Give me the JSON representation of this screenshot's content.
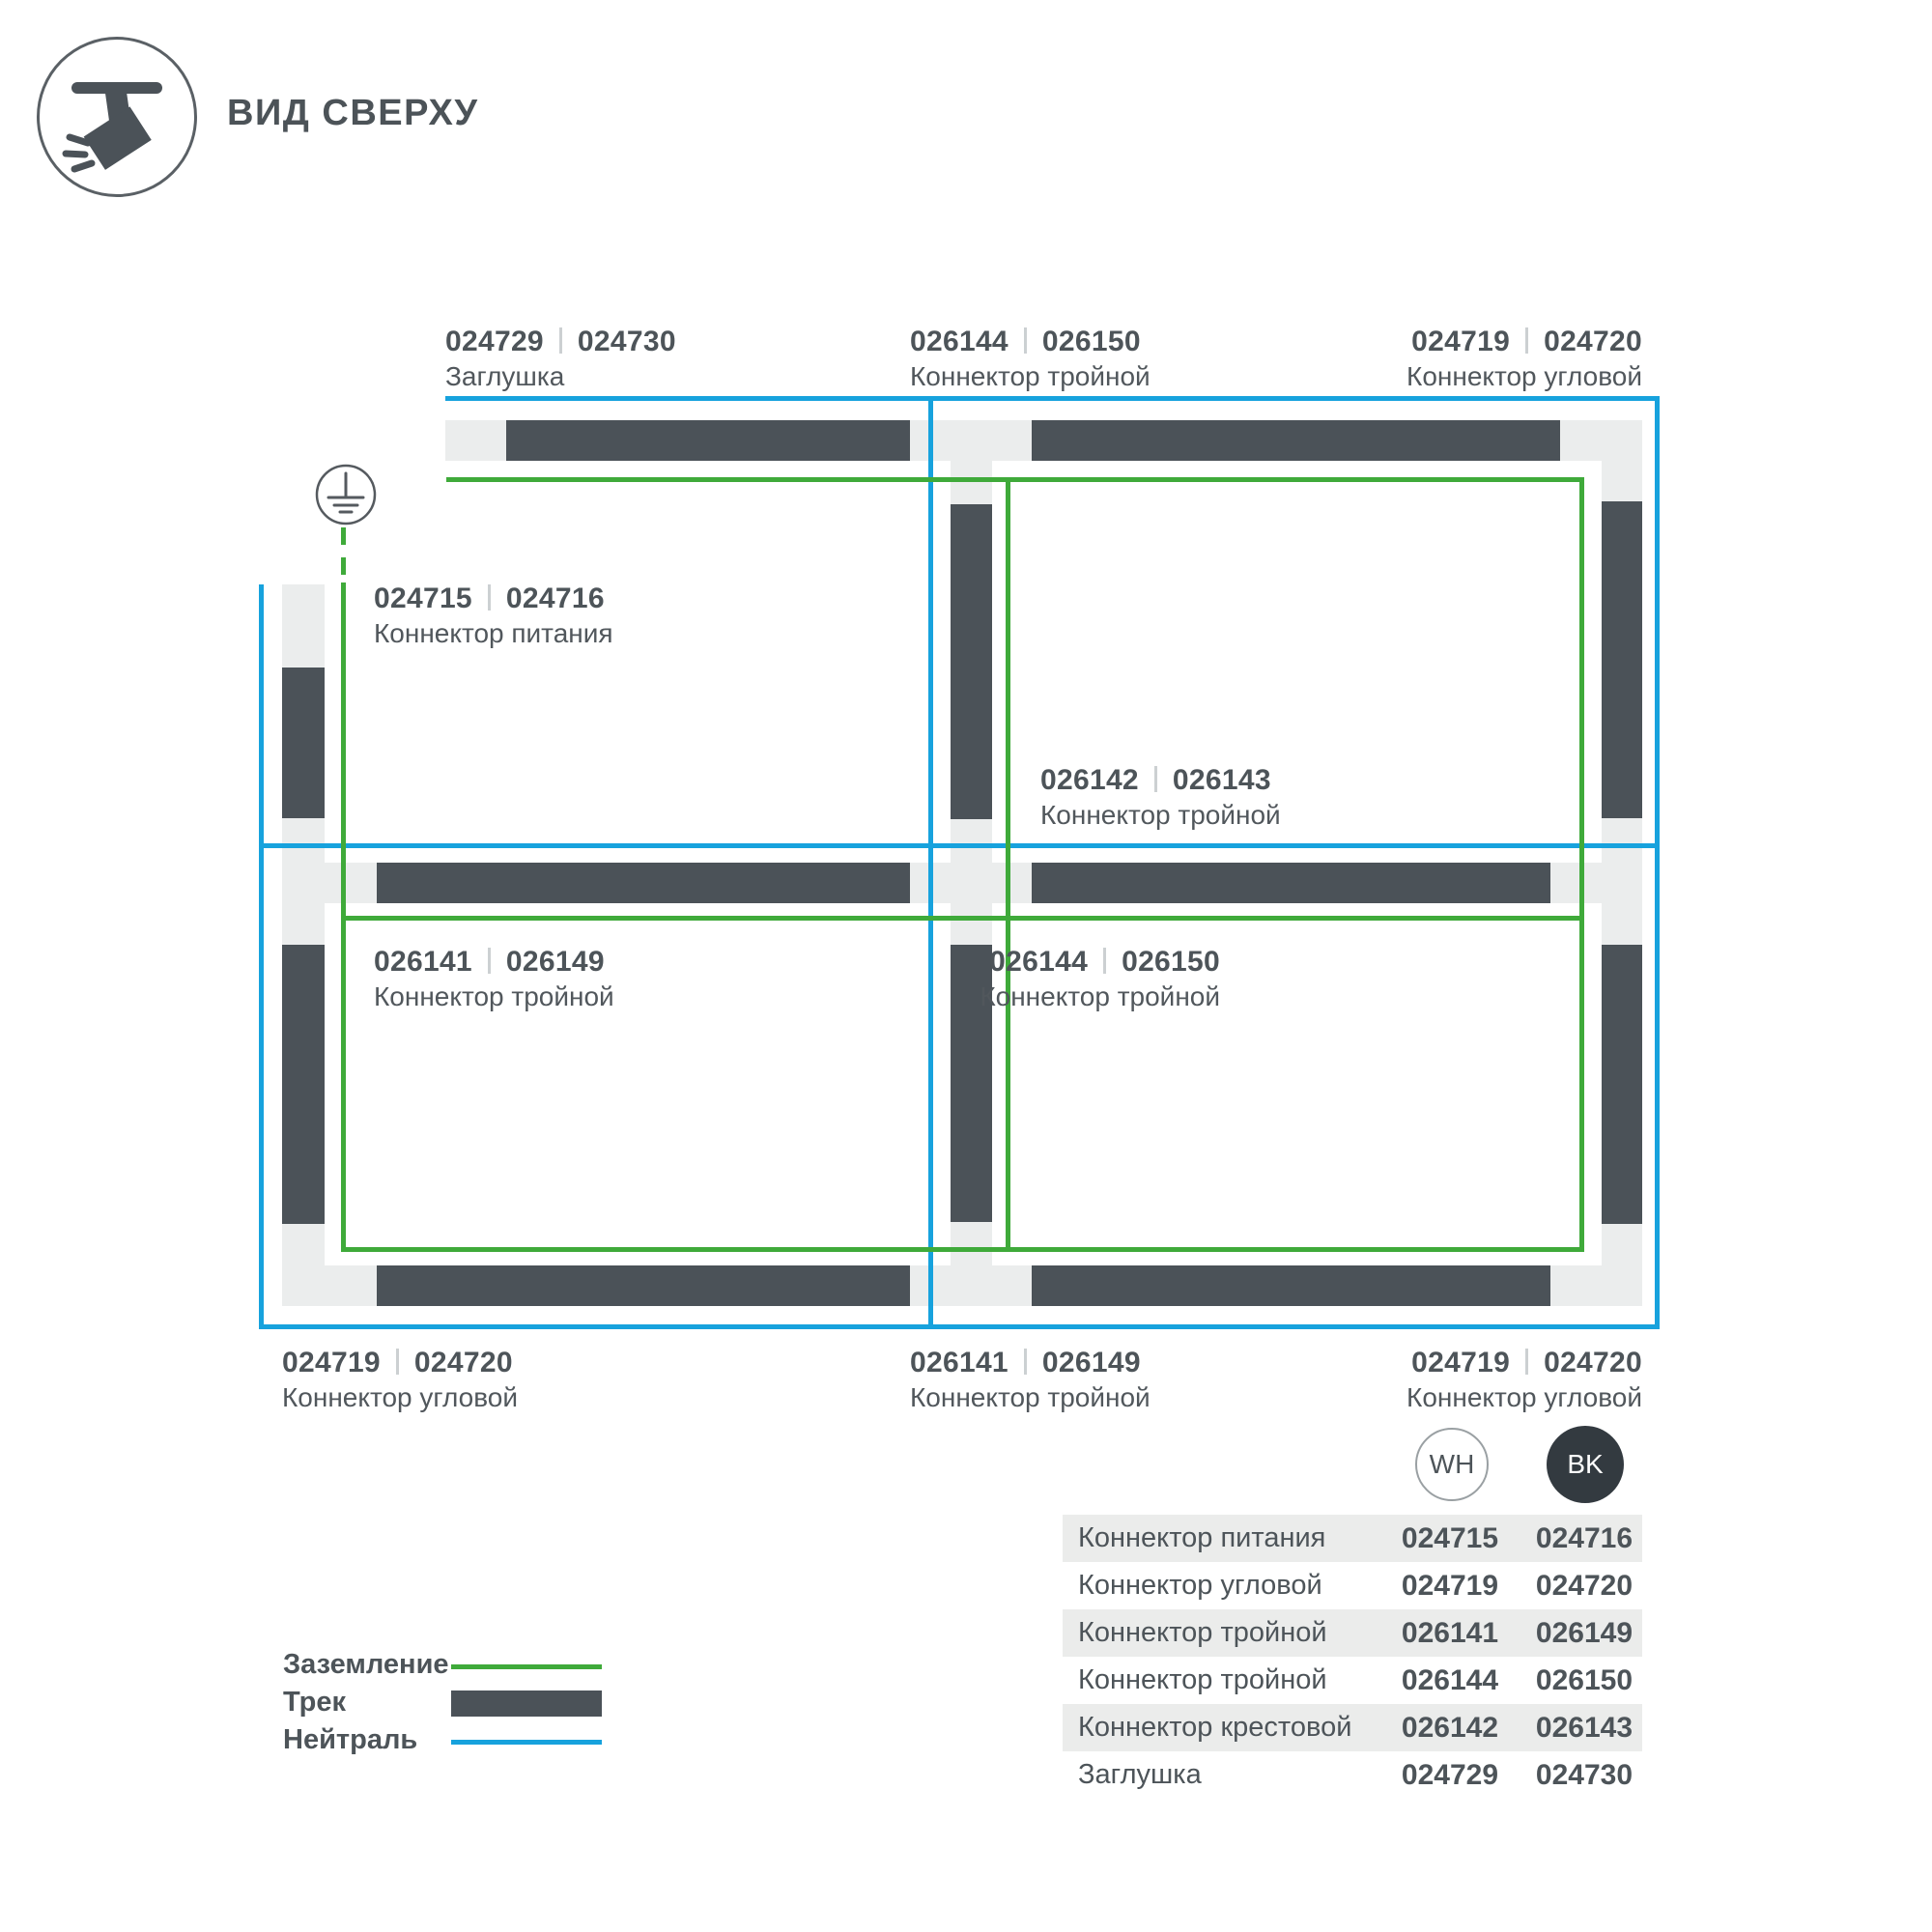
{
  "header": {
    "title": "ВИД СВЕРХУ"
  },
  "colors": {
    "track_dark": "#4b5258",
    "track_light": "#ebeded",
    "ground_green": "#3faa3a",
    "neutral_blue": "#17a2dd",
    "text": "#4d5459",
    "table_row_shade": "#ebeceb",
    "bk_badge": "#333a40"
  },
  "diagram": {
    "labels": [
      {
        "wh": "024729",
        "bk": "024730",
        "name": "Заглушка"
      },
      {
        "wh": "026144",
        "bk": "026150",
        "name": "Коннектор тройной"
      },
      {
        "wh": "024719",
        "bk": "024720",
        "name": "Коннектор угловой"
      },
      {
        "wh": "024715",
        "bk": "024716",
        "name": "Коннектор питания"
      },
      {
        "wh": "026142",
        "bk": "026143",
        "name": "Коннектор тройной"
      },
      {
        "wh": "026141",
        "bk": "026149",
        "name": "Коннектор тройной"
      },
      {
        "wh": "026144",
        "bk": "026150",
        "name": "Коннектор тройной"
      },
      {
        "wh": "024719",
        "bk": "024720",
        "name": "Коннектор угловой"
      },
      {
        "wh": "026141",
        "bk": "026149",
        "name": "Коннектор тройной"
      },
      {
        "wh": "024719",
        "bk": "024720",
        "name": "Коннектор угловой"
      }
    ]
  },
  "badges": {
    "wh": "WH",
    "bk": "BK"
  },
  "table": {
    "rows": [
      {
        "name": "Коннектор питания",
        "wh": "024715",
        "bk": "024716"
      },
      {
        "name": "Коннектор угловой",
        "wh": "024719",
        "bk": "024720"
      },
      {
        "name": "Коннектор тройной",
        "wh": "026141",
        "bk": "026149"
      },
      {
        "name": "Коннектор тройной",
        "wh": "026144",
        "bk": "026150"
      },
      {
        "name": "Коннектор крестовой",
        "wh": "026142",
        "bk": "026143"
      },
      {
        "name": "Заглушка",
        "wh": "024729",
        "bk": "024730"
      }
    ]
  },
  "legend": {
    "items": [
      {
        "label": "Заземление",
        "swatch": "ground-line"
      },
      {
        "label": "Трек",
        "swatch": "track-bar"
      },
      {
        "label": "Нейтраль",
        "swatch": "neutral-line"
      }
    ]
  }
}
